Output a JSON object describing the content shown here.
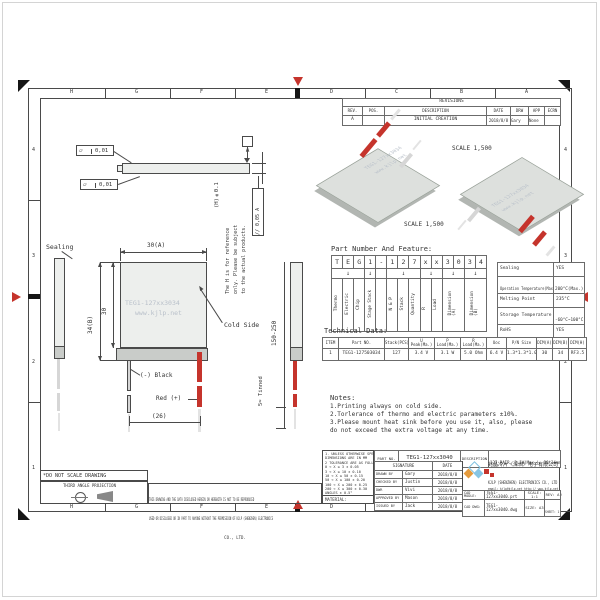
{
  "colors": {
    "accent_red": "#c5342c",
    "module_face": "#edefed",
    "module_edge": "#c9ccc9",
    "watermark": "#b9c0ca"
  },
  "zones": {
    "letters": [
      "H",
      "G",
      "F",
      "E",
      "D",
      "C",
      "B",
      "A"
    ],
    "numbers": [
      "4",
      "3",
      "2",
      "1"
    ]
  },
  "revisions": {
    "title": "REVISIONS",
    "headers": [
      "REV.",
      "POS.",
      "DESCRIPTION",
      "DATE",
      "DRW",
      "APP",
      "ECRN"
    ],
    "row": [
      "A",
      "",
      "INITIAL CREATION",
      "2018/8/8",
      "Gary",
      "None",
      ""
    ]
  },
  "iso": {
    "scale1": "SCALE  1,500",
    "scale2": "SCALE  1,500"
  },
  "watermark": {
    "line1": "TEG1-127xx3034",
    "line2": "www.kjlp.net"
  },
  "front": {
    "dim_width": "30(A)",
    "dim_height": "34(B)",
    "dim_inner": "30",
    "dim_wires": "(26)",
    "wire_len": "150-250",
    "tinned": "5≈ Tinned",
    "sealing": "Sealing",
    "cold_side": "Cold Side",
    "neg": "(-) Black",
    "pos": "Red (+)",
    "flat_sym": "▱",
    "flat1": "0,01",
    "flat2": "0,01",
    "datum": "A",
    "h_dim": "(H)±0.1",
    "parallel": "// 0,05 A",
    "note1": "The H is for reference",
    "note2": "only. Please be subject",
    "note3": "to the actual products."
  },
  "pn": {
    "title": "Part Number And Feature:",
    "chars": [
      "T",
      "E",
      "G",
      "1",
      "-",
      "1",
      "2",
      "7",
      "x",
      "x",
      "3",
      "0",
      "3",
      "4"
    ],
    "arrow": "↓",
    "labels": {
      "c1": "Thermo",
      "c2": "Electric",
      "c3": "Chip",
      "c4": "Stage Stack",
      "c6": "N & P",
      "c7": "Stack",
      "c8": "Quantity",
      "c9": "R",
      "c10": "Load",
      "c11a": "Dimension",
      "c11b": "(A)",
      "c12a": "Dimension",
      "c12b": "(B)"
    }
  },
  "features": {
    "rows": [
      [
        "Sealing",
        "YES"
      ],
      [
        "Operation Temperature(Max.)",
        "200°C(Max.)"
      ],
      [
        "Melting Point",
        "235°C"
      ],
      [
        "Storage Temperature",
        "-60°C~100°C"
      ],
      [
        "RoHS",
        "YES"
      ]
    ]
  },
  "tech": {
    "title": "Technical Data:",
    "headers": [
      "ITEM",
      "Part NO.",
      "Stack(PCS)",
      "U Peak(Ma.)",
      "P Load(Ma.)",
      "R Load(Ma.)",
      "Uoc",
      "P/N Size",
      "DIM(A)",
      "DIM(B)",
      "DIM(H)"
    ],
    "row": [
      "1",
      "TEG1-127503034",
      "127",
      "3.4 V",
      "3.1 W",
      "5.0 Ohm",
      "6.4 V",
      "1.3*1.3*1.0",
      "30",
      "34",
      "RF3.5"
    ]
  },
  "notes": {
    "title": "Notes:",
    "lines": [
      "1.Printing always on cold side.",
      "2.Torlerance of thermo and electric parameters ±10%.",
      "3.Please mount heat sink before you use it, also, please",
      "  do not exceed the extra voltage at any time."
    ]
  },
  "tol": {
    "line1": "1. UNLESS OTHERWISE SPECIFIED,",
    "line2": "DIMENSIONS ARE IN MM",
    "line3": "2 TOLERANCE ARE AS FOLLOWS:",
    "rows": [
      "0 < X ≤ 3      ± 0.05",
      "3 < X ≤ 10     ± 0.10",
      "10 < X ≤ 50    ± 0.15",
      "50 < X ≤ 100   ± 0.20",
      "100 < X ≤ 200  ± 0.25",
      "200 < X ≤ 300  ± 0.30",
      "ANGLES ± 0.5°"
    ],
    "material": "MATERIAL:"
  },
  "stamps": {
    "no_scale": "*DO NOT SCALE DRAWING",
    "third_angle": "THIRD ANGLE PROJECTION",
    "disc1": "THIS DRAWING AND THE DATA DISCLOSED HEREIN OR HEREWITH IS NOT TO BE REPRODUCED",
    "disc2": "USED OR DISCLOSED OR IN PART TO ANYONE WITHOUT THE PERMISSION OF KJLP (SHENZHEN) ELECTRONICS",
    "disc3": "CO., LTD."
  },
  "tb": {
    "part_no_label": "PART NO.",
    "part_no": "TEG1-127xx3040",
    "desc_label": "DESCRIPTION",
    "desc": "127 PAIR, 3.1W(Max.), 30*34mm",
    "sig": "SIGNATURE",
    "date": "DATE",
    "rows": [
      {
        "role": "DRAWN BY",
        "name": "Gary",
        "date": "2018/8/8"
      },
      {
        "role": "CHECKED BY",
        "name": "Justin",
        "date": "2018/8/8"
      },
      {
        "role": "DWR",
        "name": "Vivi",
        "date": "2018/8/8"
      },
      {
        "role": "APPROVED BY",
        "name": "Mason",
        "date": "2018/8/8"
      },
      {
        "role": "ISSUED BY",
        "name": "Jack",
        "date": "2018/8/8"
      }
    ],
    "company_cn": "兆晶冷片（深圳）电子有限公司",
    "company_en": "KJLP (SHENZHEN) ELECTRONICS CO., LTD",
    "contact1": "email: kjlp@kjlp.net   http:// www.kjlp.net",
    "contact2": "Tel: +86-755-82536032   Fax: +86-755-22628899",
    "cad_model_label": "CAD MODLE:",
    "cad_model": "TEG1-127xx3040.prt",
    "cad_dwg_label": "CAD DWG:",
    "cad_dwg": "TEG1-127xx3040.dwg",
    "scale": "SCALE: 1:1",
    "rev": "REV: A",
    "size": "SIZE: A3",
    "sheet": "SHEET: 1 OF 1"
  }
}
